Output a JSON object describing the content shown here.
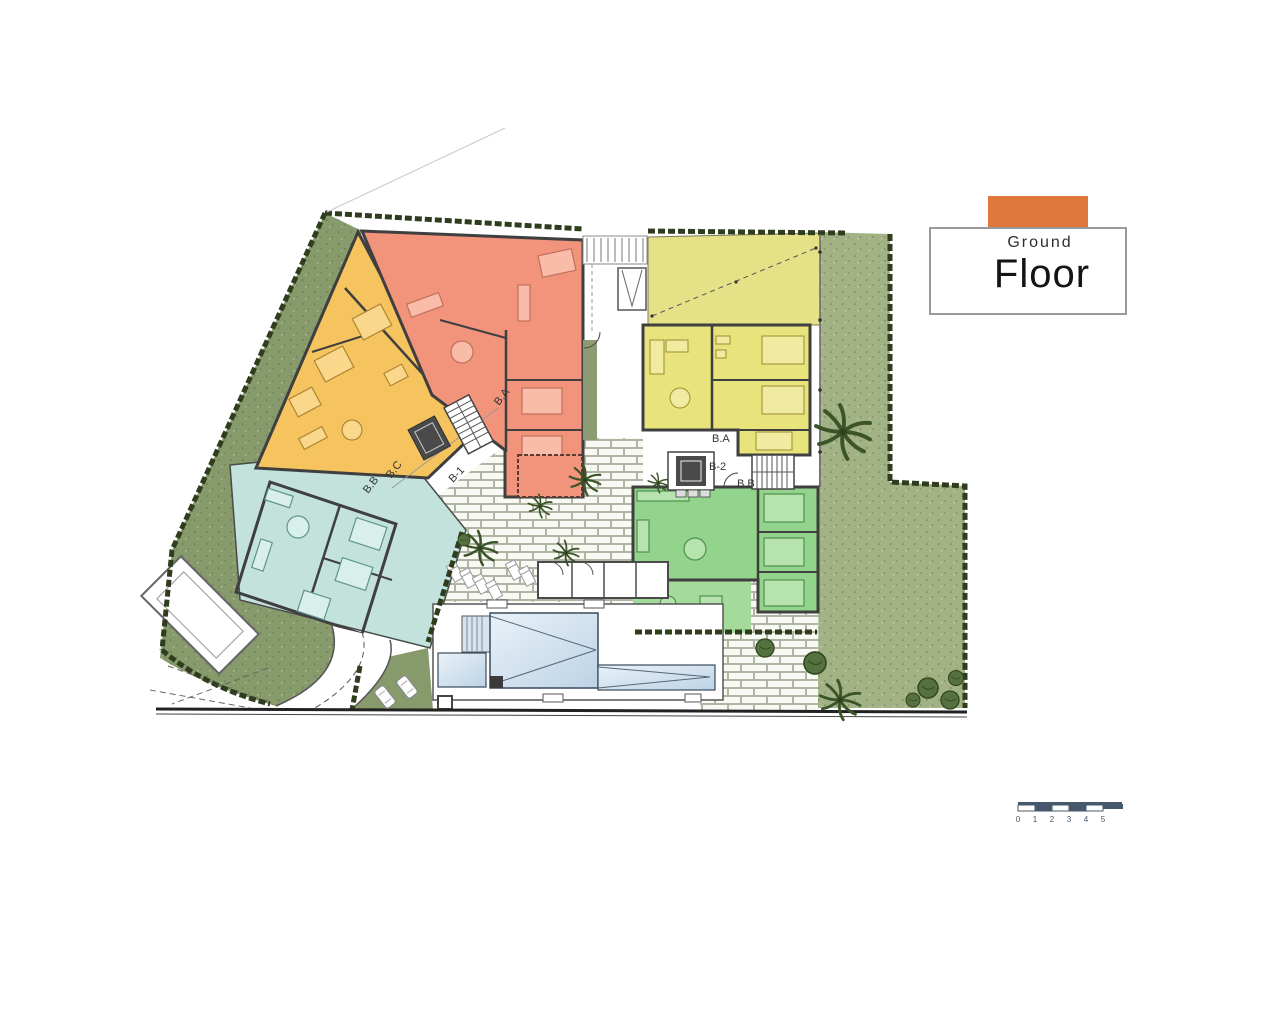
{
  "title_block": {
    "line1": "Ground",
    "line2": "Floor"
  },
  "scale_bar": {
    "ticks": [
      "0",
      "1",
      "2",
      "3",
      "4",
      "5"
    ]
  },
  "plan": {
    "labels": {
      "stair_bb_west": "B.B",
      "stair_bc_west": "B.C",
      "stair_ba_west": "B.A",
      "block_b1": "B-1",
      "stair_ba_east": "B.A",
      "block_b2": "B-2",
      "stair_bb_east": "B.B"
    },
    "colors": {
      "accent_orange": "#E0773D",
      "unit_amber": "#F6C45E",
      "unit_salmon": "#F2937B",
      "unit_yellow": "#E9E37C",
      "unit_yellow_garden": "#E4E186",
      "unit_green": "#92D48C",
      "unit_green_terrace": "#A4DB9B",
      "unit_teal": "#C2E2DB",
      "lawn_dark": "#879A6C",
      "lawn_light": "#A3B285",
      "hedge": "#2F3D1E",
      "paving_base": "#E0E4D0",
      "pool_blue": "#C9DCEA",
      "wall": "#3F3F3F",
      "scale_navy": "#46586B"
    }
  }
}
